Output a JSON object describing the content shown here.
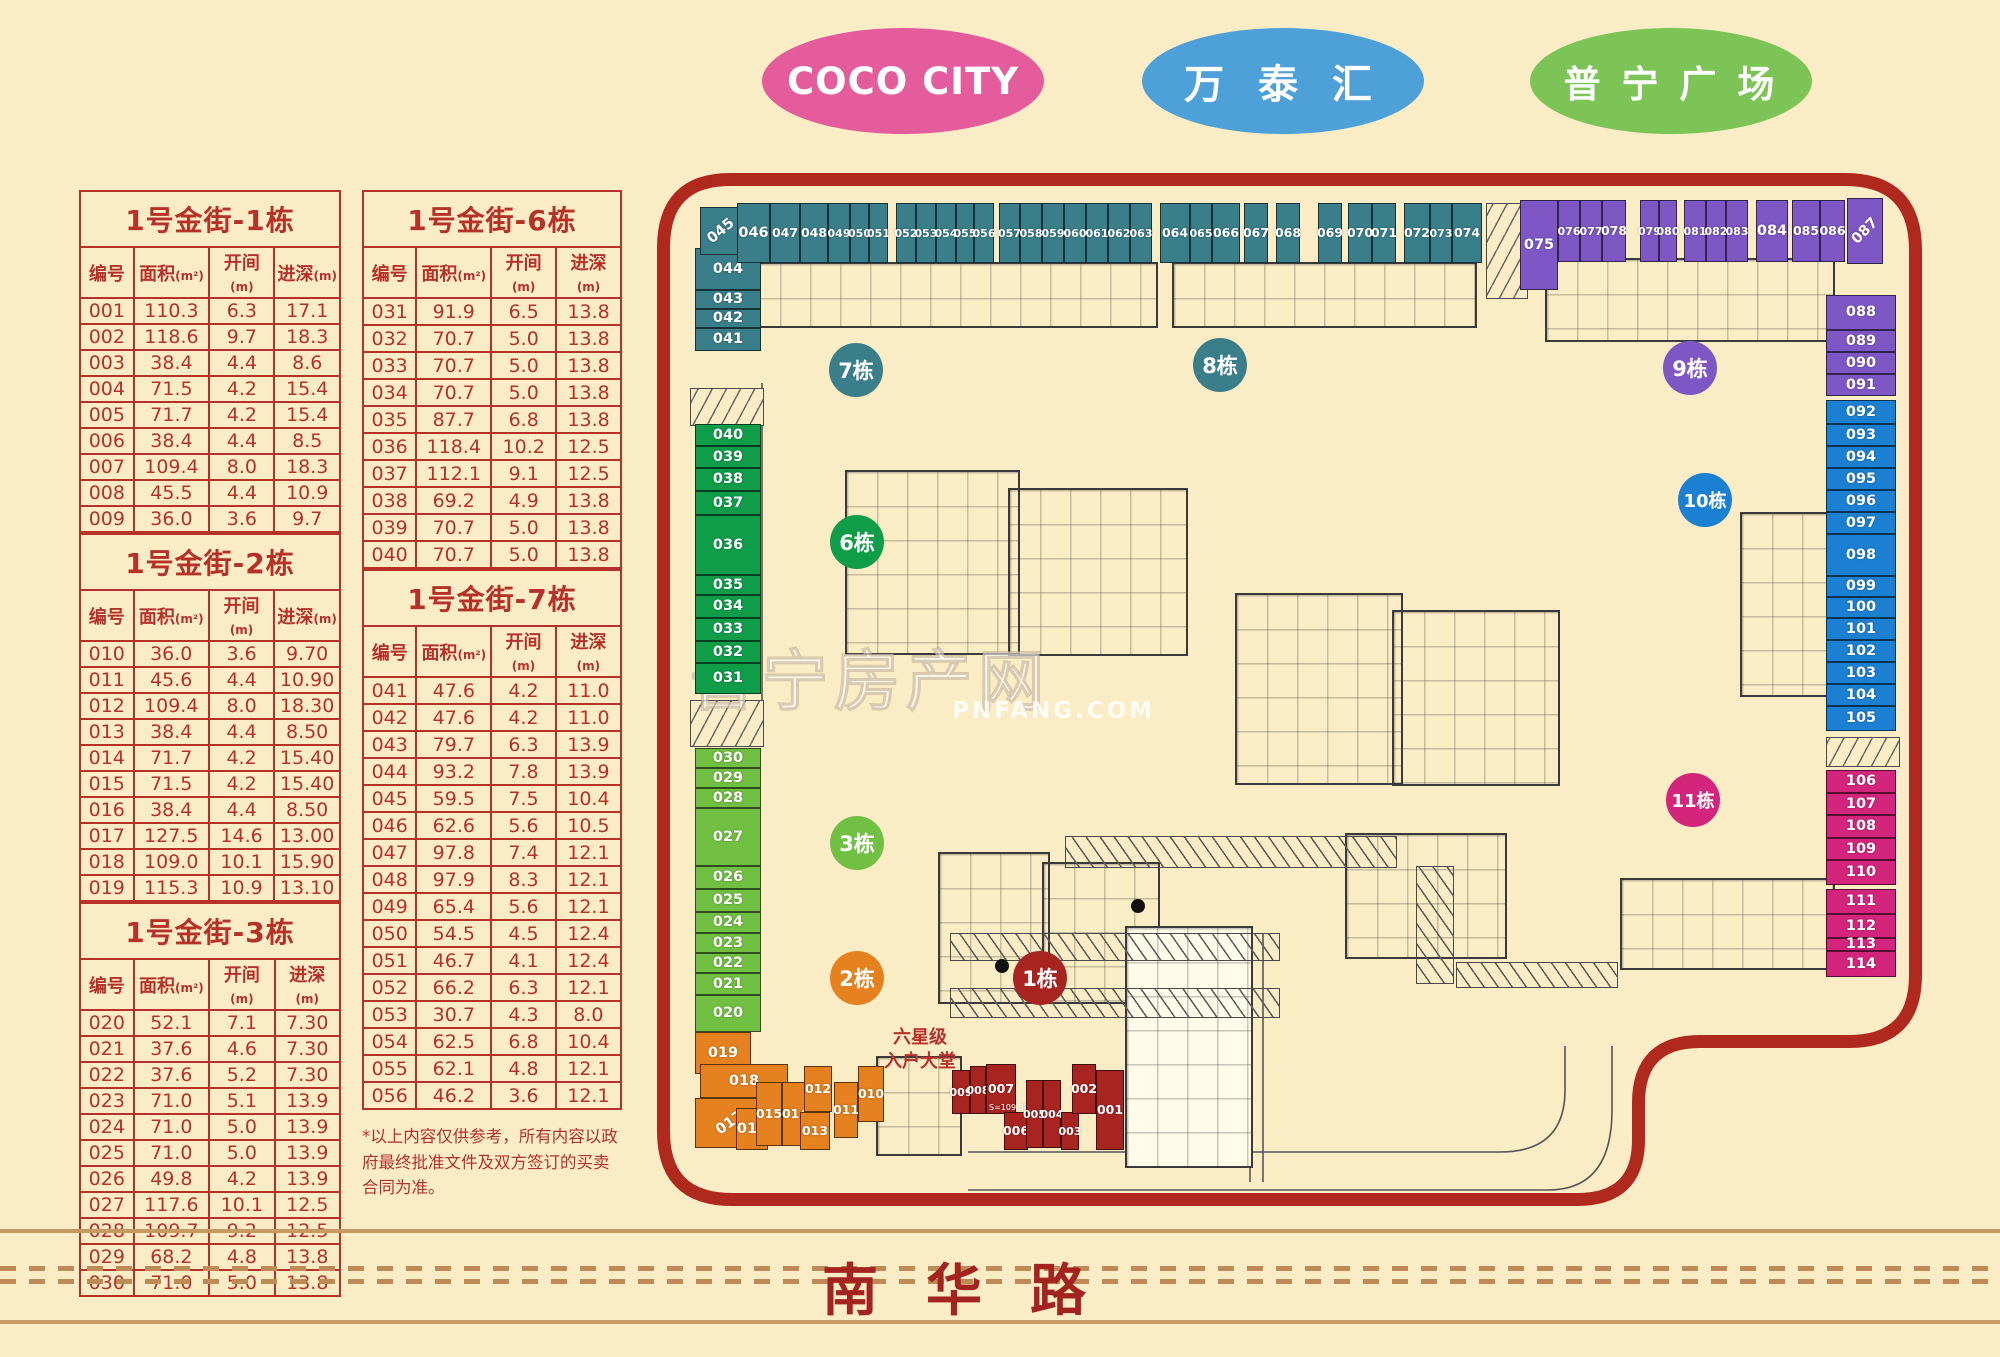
{
  "landmarks": [
    {
      "id": "coco-city",
      "label": "COCO CITY",
      "color": "#e45c9c"
    },
    {
      "id": "wantaihui",
      "label": "万 泰 汇",
      "color": "#4da0d8"
    },
    {
      "id": "puning-plaza",
      "label": "普 宁 广 场",
      "color": "#7cc456"
    }
  ],
  "tables": [
    {
      "col": "a",
      "title": "1号金街-1栋",
      "headers": [
        "编号",
        "面积",
        "开间",
        "进深"
      ],
      "header_units": [
        "",
        "(m²)",
        "(m)",
        "(m)"
      ],
      "rows": [
        [
          "001",
          "110.3",
          "6.3",
          "17.1"
        ],
        [
          "002",
          "118.6",
          "9.7",
          "18.3"
        ],
        [
          "003",
          "38.4",
          "4.4",
          "8.6"
        ],
        [
          "004",
          "71.5",
          "4.2",
          "15.4"
        ],
        [
          "005",
          "71.7",
          "4.2",
          "15.4"
        ],
        [
          "006",
          "38.4",
          "4.4",
          "8.5"
        ],
        [
          "007",
          "109.4",
          "8.0",
          "18.3"
        ],
        [
          "008",
          "45.5",
          "4.4",
          "10.9"
        ],
        [
          "009",
          "36.0",
          "3.6",
          "9.7"
        ]
      ]
    },
    {
      "col": "a",
      "title": "1号金街-2栋",
      "headers": [
        "编号",
        "面积",
        "开间",
        "进深"
      ],
      "header_units": [
        "",
        "(m²)",
        "(m)",
        "(m)"
      ],
      "rows": [
        [
          "010",
          "36.0",
          "3.6",
          "9.70"
        ],
        [
          "011",
          "45.6",
          "4.4",
          "10.90"
        ],
        [
          "012",
          "109.4",
          "8.0",
          "18.30"
        ],
        [
          "013",
          "38.4",
          "4.4",
          "8.50"
        ],
        [
          "014",
          "71.7",
          "4.2",
          "15.40"
        ],
        [
          "015",
          "71.5",
          "4.2",
          "15.40"
        ],
        [
          "016",
          "38.4",
          "4.4",
          "8.50"
        ],
        [
          "017",
          "127.5",
          "14.6",
          "13.00"
        ],
        [
          "018",
          "109.0",
          "10.1",
          "15.90"
        ],
        [
          "019",
          "115.3",
          "10.9",
          "13.10"
        ]
      ]
    },
    {
      "col": "a",
      "title": "1号金街-3栋",
      "headers": [
        "编号",
        "面积",
        "开间",
        "进深"
      ],
      "header_units": [
        "",
        "(m²)",
        "(m)",
        "(m)"
      ],
      "rows": [
        [
          "020",
          "52.1",
          "7.1",
          "7.30"
        ],
        [
          "021",
          "37.6",
          "4.6",
          "7.30"
        ],
        [
          "022",
          "37.6",
          "5.2",
          "7.30"
        ],
        [
          "023",
          "71.0",
          "5.1",
          "13.9"
        ],
        [
          "024",
          "71.0",
          "5.0",
          "13.9"
        ],
        [
          "025",
          "71.0",
          "5.0",
          "13.9"
        ],
        [
          "026",
          "49.8",
          "4.2",
          "13.9"
        ],
        [
          "027",
          "117.6",
          "10.1",
          "12.5"
        ],
        [
          "028",
          "109.7",
          "9.2",
          "12.5"
        ],
        [
          "029",
          "68.2",
          "4.8",
          "13.8"
        ],
        [
          "030",
          "71.0",
          "5.0",
          "13.8"
        ]
      ]
    },
    {
      "col": "b",
      "title": "1号金街-6栋",
      "headers": [
        "编号",
        "面积",
        "开间",
        "进深"
      ],
      "header_units": [
        "",
        "(m²)",
        "(m)",
        "(m)"
      ],
      "rows": [
        [
          "031",
          "91.9",
          "6.5",
          "13.8"
        ],
        [
          "032",
          "70.7",
          "5.0",
          "13.8"
        ],
        [
          "033",
          "70.7",
          "5.0",
          "13.8"
        ],
        [
          "034",
          "70.7",
          "5.0",
          "13.8"
        ],
        [
          "035",
          "87.7",
          "6.8",
          "13.8"
        ],
        [
          "036",
          "118.4",
          "10.2",
          "12.5"
        ],
        [
          "037",
          "112.1",
          "9.1",
          "12.5"
        ],
        [
          "038",
          "69.2",
          "4.9",
          "13.8"
        ],
        [
          "039",
          "70.7",
          "5.0",
          "13.8"
        ],
        [
          "040",
          "70.7",
          "5.0",
          "13.8"
        ]
      ]
    },
    {
      "col": "b",
      "title": "1号金街-7栋",
      "headers": [
        "编号",
        "面积",
        "开间",
        "进深"
      ],
      "header_units": [
        "",
        "(m²)",
        "(m)",
        "(m)"
      ],
      "rows": [
        [
          "041",
          "47.6",
          "4.2",
          "11.0"
        ],
        [
          "042",
          "47.6",
          "4.2",
          "11.0"
        ],
        [
          "043",
          "79.7",
          "6.3",
          "13.9"
        ],
        [
          "044",
          "93.2",
          "7.8",
          "13.9"
        ],
        [
          "045",
          "59.5",
          "7.5",
          "10.4"
        ],
        [
          "046",
          "62.6",
          "5.6",
          "10.5"
        ],
        [
          "047",
          "97.8",
          "7.4",
          "12.1"
        ],
        [
          "048",
          "97.9",
          "8.3",
          "12.1"
        ],
        [
          "049",
          "65.4",
          "5.6",
          "12.1"
        ],
        [
          "050",
          "54.5",
          "4.5",
          "12.4"
        ],
        [
          "051",
          "46.7",
          "4.1",
          "12.4"
        ],
        [
          "052",
          "66.2",
          "6.3",
          "12.1"
        ],
        [
          "053",
          "30.7",
          "4.3",
          "8.0"
        ],
        [
          "054",
          "62.5",
          "6.8",
          "10.4"
        ],
        [
          "055",
          "62.1",
          "4.8",
          "12.1"
        ],
        [
          "056",
          "46.2",
          "3.6",
          "12.1"
        ]
      ]
    }
  ],
  "footnote": "*以上内容仅供参考，所有内容以政府最终批准文件及双方签订的买卖合同为准。",
  "map": {
    "border_color": "#b0291f",
    "lobby_lines": [
      "六星级",
      "入户大堂"
    ],
    "watermark_text": "普宁房产网",
    "watermark_sub": "PNFANG.COM",
    "unit_sublabels": {
      "007": "S=109.3825"
    },
    "buildings": [
      {
        "id": "b1",
        "label": "1栋",
        "color": "#a82420"
      },
      {
        "id": "b2",
        "label": "2栋",
        "color": "#e5821f"
      },
      {
        "id": "b3",
        "label": "3栋",
        "color": "#72c043"
      },
      {
        "id": "b6",
        "label": "6栋",
        "color": "#0f9d4a"
      },
      {
        "id": "b7",
        "label": "7栋",
        "color": "#3a7e89"
      },
      {
        "id": "b8",
        "label": "8栋",
        "color": "#3a7e89"
      },
      {
        "id": "b9",
        "label": "9栋",
        "color": "#7e57c5"
      },
      {
        "id": "b10",
        "label": "10栋",
        "color": "#1b80d2"
      },
      {
        "id": "b11",
        "label": "11栋",
        "color": "#d4257d"
      }
    ],
    "shop_groups": [
      {
        "name": "left-teal",
        "color": "#3a7e89",
        "units": [
          "044",
          "043",
          "042",
          "041"
        ]
      },
      {
        "name": "top-teal",
        "color": "#3a7e89",
        "units": [
          "045",
          "046",
          "047",
          "048",
          "049",
          "050",
          "051",
          "052",
          "053",
          "054",
          "055",
          "056",
          "057",
          "058",
          "059",
          "060",
          "061",
          "062",
          "063",
          "064",
          "065",
          "066",
          "067",
          "068",
          "069",
          "070",
          "071",
          "072",
          "073",
          "074"
        ]
      },
      {
        "name": "top-purple",
        "color": "#7e57c5",
        "units": [
          "075",
          "076",
          "077",
          "078",
          "079",
          "080",
          "081",
          "082",
          "083",
          "084",
          "085",
          "086",
          "087"
        ]
      },
      {
        "name": "right-purple",
        "color": "#7e57c5",
        "units": [
          "088",
          "089",
          "090",
          "091"
        ]
      },
      {
        "name": "right-blue",
        "color": "#1b80d2",
        "units": [
          "092",
          "093",
          "094",
          "095",
          "096",
          "097",
          "098",
          "099",
          "100",
          "101",
          "102",
          "103",
          "104",
          "105"
        ]
      },
      {
        "name": "right-magenta",
        "color": "#d4257d",
        "units": [
          "106",
          "107",
          "108",
          "109",
          "110",
          "111",
          "112",
          "113",
          "114"
        ]
      },
      {
        "name": "left-green",
        "color": "#0f9d4a",
        "units": [
          "040",
          "039",
          "038",
          "037",
          "036",
          "035",
          "034",
          "033",
          "032",
          "031"
        ]
      },
      {
        "name": "left-lightgreen",
        "color": "#72c043",
        "units": [
          "030",
          "029",
          "028",
          "027",
          "026",
          "025",
          "024",
          "023",
          "022",
          "021",
          "020"
        ]
      },
      {
        "name": "bottom-orange",
        "color": "#e5821f",
        "units": [
          "019",
          "018",
          "017",
          "016",
          "015",
          "014",
          "013",
          "012",
          "011",
          "010"
        ]
      },
      {
        "name": "bottom-red",
        "color": "#a82420",
        "units": [
          "009",
          "008",
          "007",
          "006",
          "005",
          "004",
          "003",
          "002",
          "001"
        ]
      }
    ]
  },
  "road": {
    "label": "南华路"
  }
}
